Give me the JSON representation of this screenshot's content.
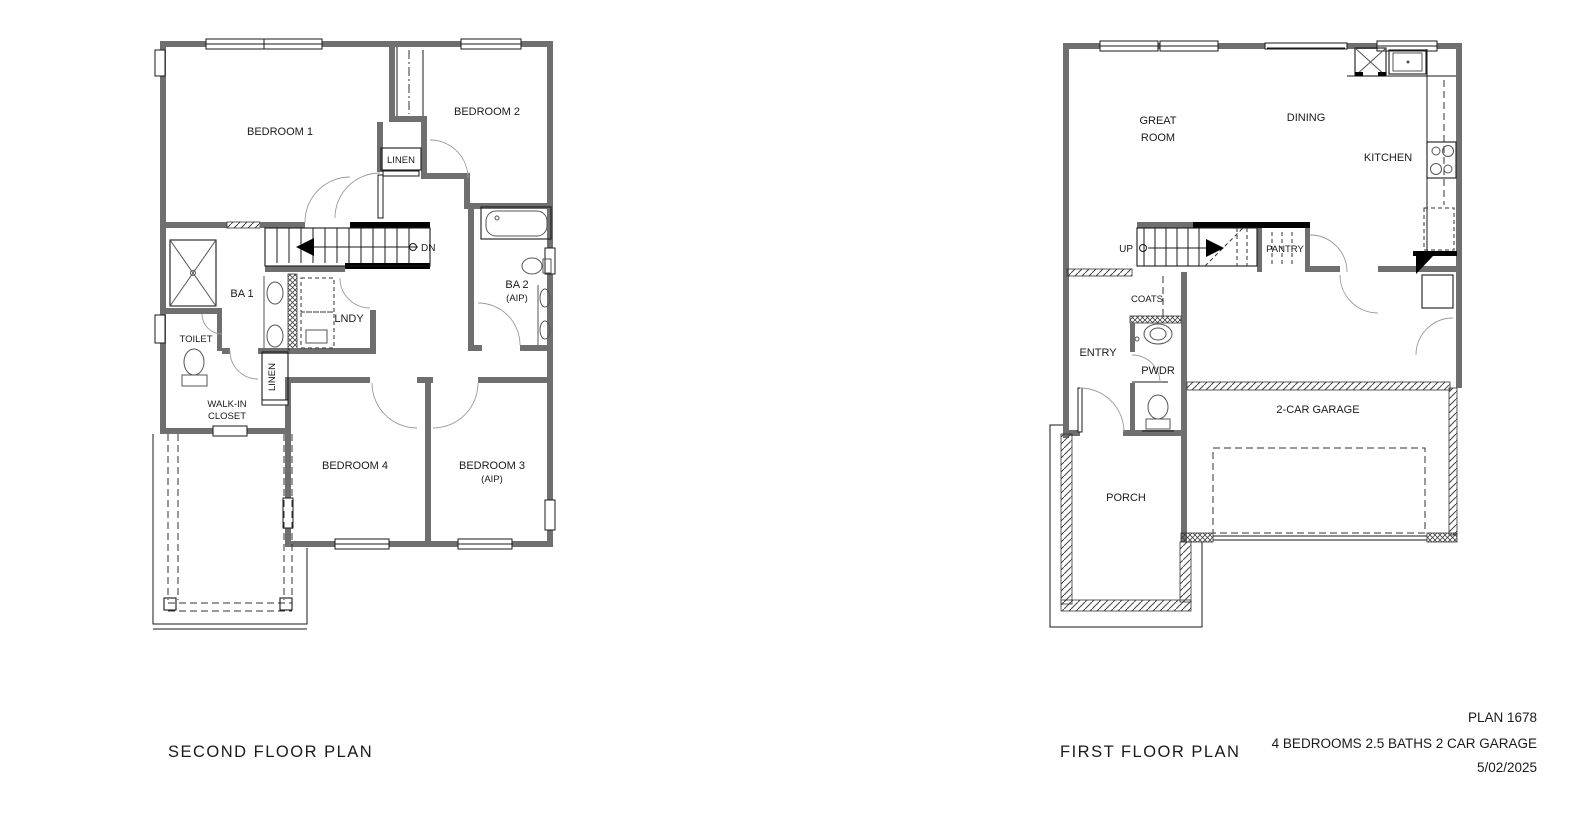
{
  "second_floor": {
    "title": "SECOND FLOOR PLAN",
    "rooms": {
      "bedroom1": "BEDROOM 1",
      "bedroom2": "BEDROOM 2",
      "linen_upper": "LINEN",
      "dn": "DN",
      "ba1": "BA 1",
      "toilet": "TOILET",
      "lndy": "LNDY",
      "linen_lower": "LINEN",
      "ba2": "BA 2",
      "ba2_note": "(AIP)",
      "walkin1": "WALK-IN",
      "walkin2": "CLOSET",
      "bedroom4": "BEDROOM 4",
      "bedroom3": "BEDROOM 3",
      "bedroom3_note": "(AIP)"
    }
  },
  "first_floor": {
    "title": "FIRST FLOOR PLAN",
    "rooms": {
      "great1": "GREAT",
      "great2": "ROOM",
      "dining": "DINING",
      "kitchen": "KITCHEN",
      "up": "UP",
      "pantry": "PANTRY",
      "coats": "COATS",
      "entry": "ENTRY",
      "pwdr": "PWDR",
      "garage": "2-CAR GARAGE",
      "porch": "PORCH"
    }
  },
  "info": {
    "plan_number": "PLAN 1678",
    "specs": "4 BEDROOMS 2.5 BATHS 2 CAR GARAGE",
    "date": "5/02/2025"
  },
  "colors": {
    "wall": "#6f6f6f",
    "line": "#1a1a1a",
    "background": "#ffffff"
  }
}
